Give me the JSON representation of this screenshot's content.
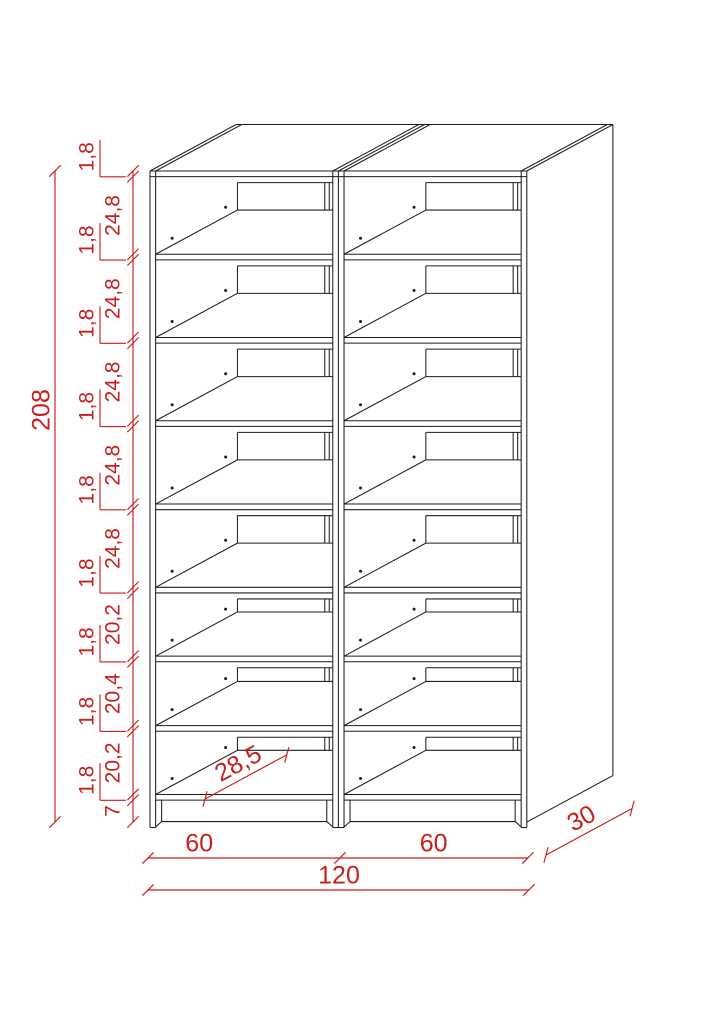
{
  "drawing": {
    "kind": "furniture-technical-drawing",
    "object": "double-column shelving cabinet, oblique projection",
    "columns": 2,
    "compartments_per_column": 8
  },
  "dimensions": {
    "overall_height": "208",
    "overall_width": "120",
    "depth": "30",
    "shelf_depth": "28,5",
    "plinth_height": "7",
    "column_widths": [
      "60",
      "60"
    ],
    "height_chain": [
      "1,8",
      "24,8",
      "1,8",
      "24,8",
      "1,8",
      "24,8",
      "1,8",
      "24,8",
      "1,8",
      "24,8",
      "1,8",
      "20,2",
      "1,8",
      "20,4",
      "1,8",
      "20,2",
      "1,8",
      "7"
    ]
  },
  "colors": {
    "outline": "#1d1d1d",
    "dimension": "#c81e1e",
    "background": "#ffffff"
  }
}
